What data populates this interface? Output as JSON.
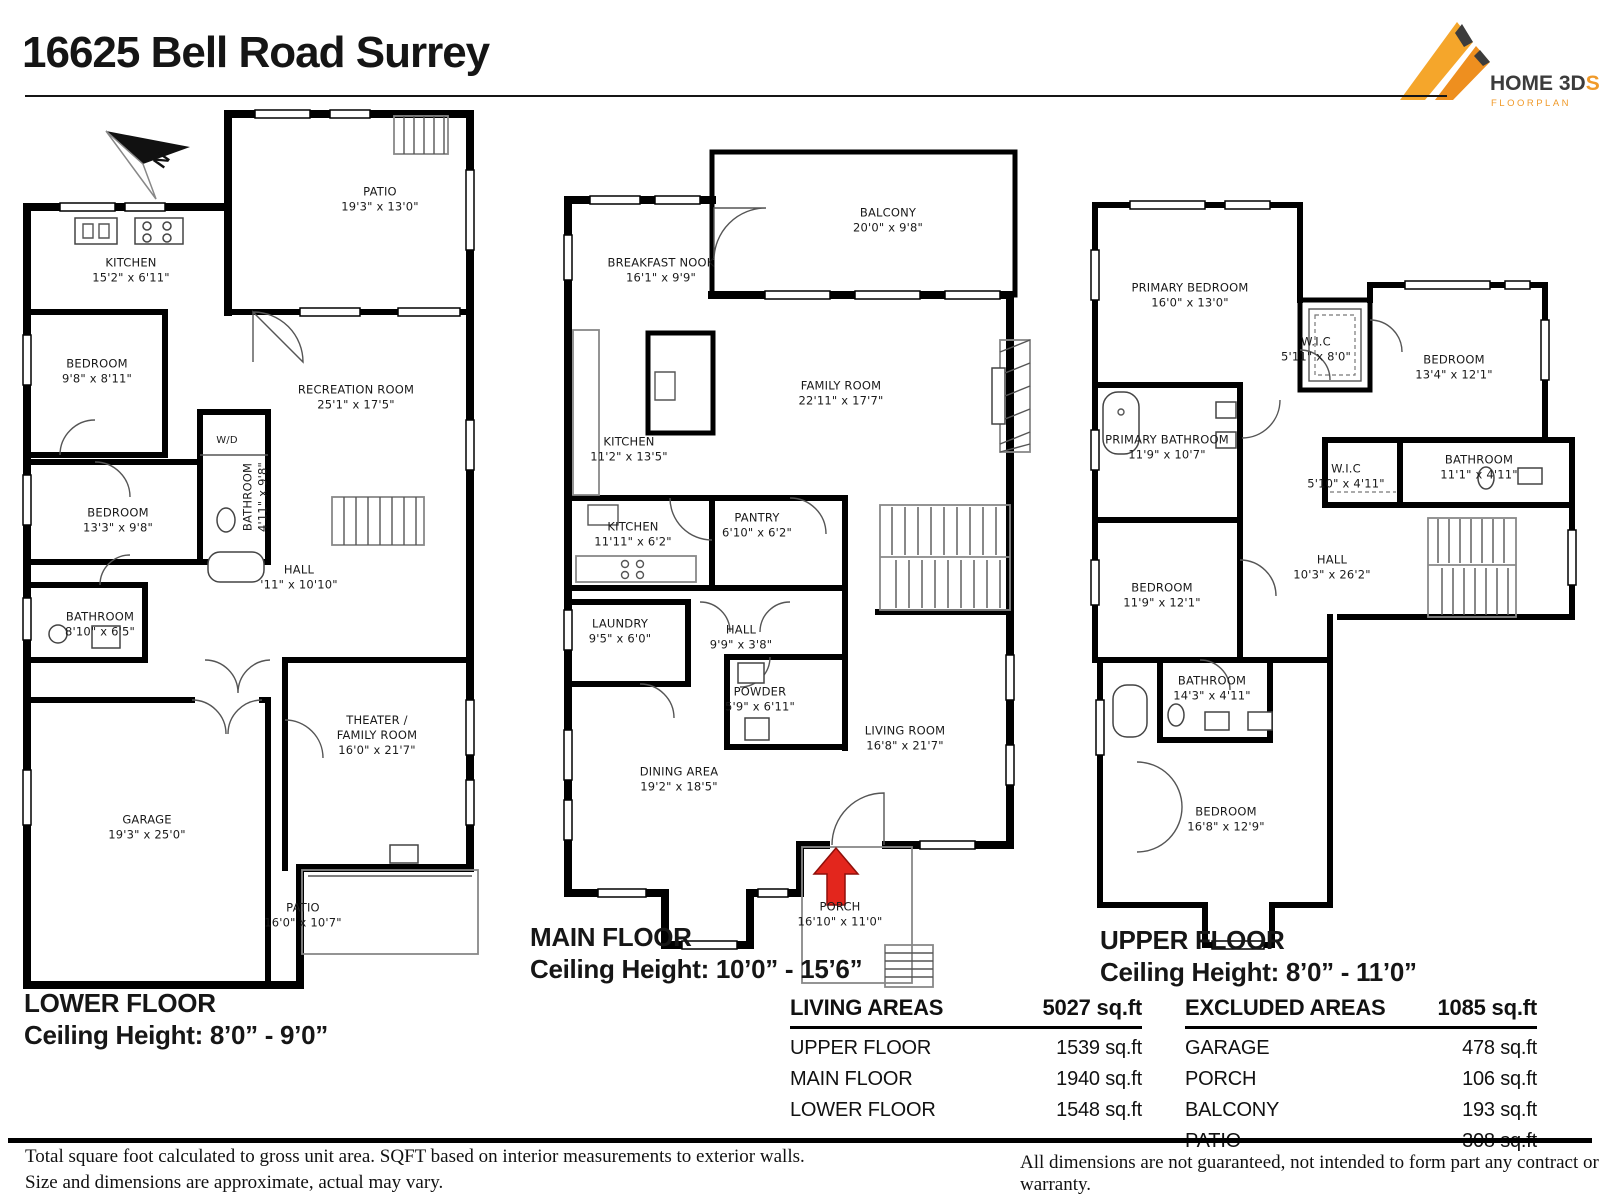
{
  "title": "16625 Bell Road Surrey",
  "logo": {
    "name": "HOME 3D",
    "accent": "S",
    "subtitle": "FLOORPLAN",
    "orange": "#F09A2A",
    "text_color": "#3C3C3C"
  },
  "compass": {
    "label": "N"
  },
  "colors": {
    "walls": "#000000",
    "entry_arrow": "#E3261D"
  },
  "floors": {
    "lower": {
      "title": "LOWER FLOOR",
      "ceiling": "Ceiling Height: 8’0” - 9’0”",
      "rooms": [
        {
          "name": "PATIO",
          "dims": "19'3\" x 13'0\""
        },
        {
          "name": "KITCHEN",
          "dims": "15'2\" x 6'11\""
        },
        {
          "name": "BEDROOM",
          "dims": "9'8\" x 8'11\""
        },
        {
          "name": "RECREATION ROOM",
          "dims": "25'1\" x 17'5\""
        },
        {
          "name": "W/D",
          "dims": ""
        },
        {
          "name": "BEDROOM",
          "dims": "13'3\" x 9'8\""
        },
        {
          "name": "BATHROOM",
          "dims": "4'11\" x 9'8\""
        },
        {
          "name": "HALL",
          "dims": "'11\" x 10'10\""
        },
        {
          "name": "BATHROOM",
          "dims": "8'10\" x 6'5\""
        },
        {
          "name": "THEATER /\nFAMILY ROOM",
          "dims": "16'0\" x 21'7\""
        },
        {
          "name": "GARAGE",
          "dims": "19'3\" x 25'0\""
        },
        {
          "name": "PATIO",
          "dims": "16'0\" x 10'7\""
        }
      ]
    },
    "main": {
      "title": "MAIN FLOOR",
      "ceiling": "Ceiling Height: 10’0” - 15’6”",
      "rooms": [
        {
          "name": "BALCONY",
          "dims": "20'0\" x 9'8\""
        },
        {
          "name": "BREAKFAST NOOK",
          "dims": "16'1\" x 9'9\""
        },
        {
          "name": "FAMILY ROOM",
          "dims": "22'11\" x 17'7\""
        },
        {
          "name": "KITCHEN",
          "dims": "11'2\" x 13'5\""
        },
        {
          "name": "KITCHEN",
          "dims": "11'11\" x 6'2\""
        },
        {
          "name": "PANTRY",
          "dims": "6'10\" x 6'2\""
        },
        {
          "name": "LAUNDRY",
          "dims": "9'5\" x 6'0\""
        },
        {
          "name": "HALL",
          "dims": "9'9\" x 3'8\""
        },
        {
          "name": "POWDER",
          "dims": "5'9\" x 6'11\""
        },
        {
          "name": "LIVING ROOM",
          "dims": "16'8\" x 21'7\""
        },
        {
          "name": "DINING AREA",
          "dims": "19'2\" x 18'5\""
        },
        {
          "name": "PORCH",
          "dims": "16'10\" x 11'0\""
        }
      ]
    },
    "upper": {
      "title": "UPPER FLOOR",
      "ceiling": "Ceiling Height: 8’0” - 11’0”",
      "rooms": [
        {
          "name": "PRIMARY BEDROOM",
          "dims": "16'0\" x 13'0\""
        },
        {
          "name": "W.I.C",
          "dims": "5'11\" x 8'0\""
        },
        {
          "name": "BEDROOM",
          "dims": "13'4\" x 12'1\""
        },
        {
          "name": "PRIMARY BATHROOM",
          "dims": "11'9\" x 10'7\""
        },
        {
          "name": "W.I.C",
          "dims": "5'10\" x 4'11\""
        },
        {
          "name": "BATHROOM",
          "dims": "11'1\" x 4'11\""
        },
        {
          "name": "BEDROOM",
          "dims": "11'9\" x 12'1\""
        },
        {
          "name": "HALL",
          "dims": "10'3\" x 26'2\""
        },
        {
          "name": "BATHROOM",
          "dims": "14'3\" x 4'11\""
        },
        {
          "name": "BEDROOM",
          "dims": "16'8\" x 12'9\""
        }
      ]
    }
  },
  "living_areas": {
    "header": "LIVING AREAS",
    "total": "5027 sq.ft",
    "rows": [
      {
        "label": "UPPER FLOOR",
        "value": "1539 sq.ft"
      },
      {
        "label": "MAIN FLOOR",
        "value": "1940 sq.ft"
      },
      {
        "label": "LOWER FLOOR",
        "value": "1548 sq.ft"
      }
    ]
  },
  "excluded_areas": {
    "header": "EXCLUDED AREAS",
    "total": "1085 sq.ft",
    "rows": [
      {
        "label": "GARAGE",
        "value": "478 sq.ft"
      },
      {
        "label": "PORCH",
        "value": "106 sq.ft"
      },
      {
        "label": "BALCONY",
        "value": "193 sq.ft"
      },
      {
        "label": "PATIO",
        "value": "308 sq.ft"
      }
    ]
  },
  "footer": {
    "left_line1": "Total square foot calculated to gross unit area. SQFT based on interior measurements to exterior walls.",
    "left_line2": "Size and dimensions are approximate, actual may vary.",
    "right": "All dimensions are not guaranteed, not intended to form part any contract or warranty."
  }
}
